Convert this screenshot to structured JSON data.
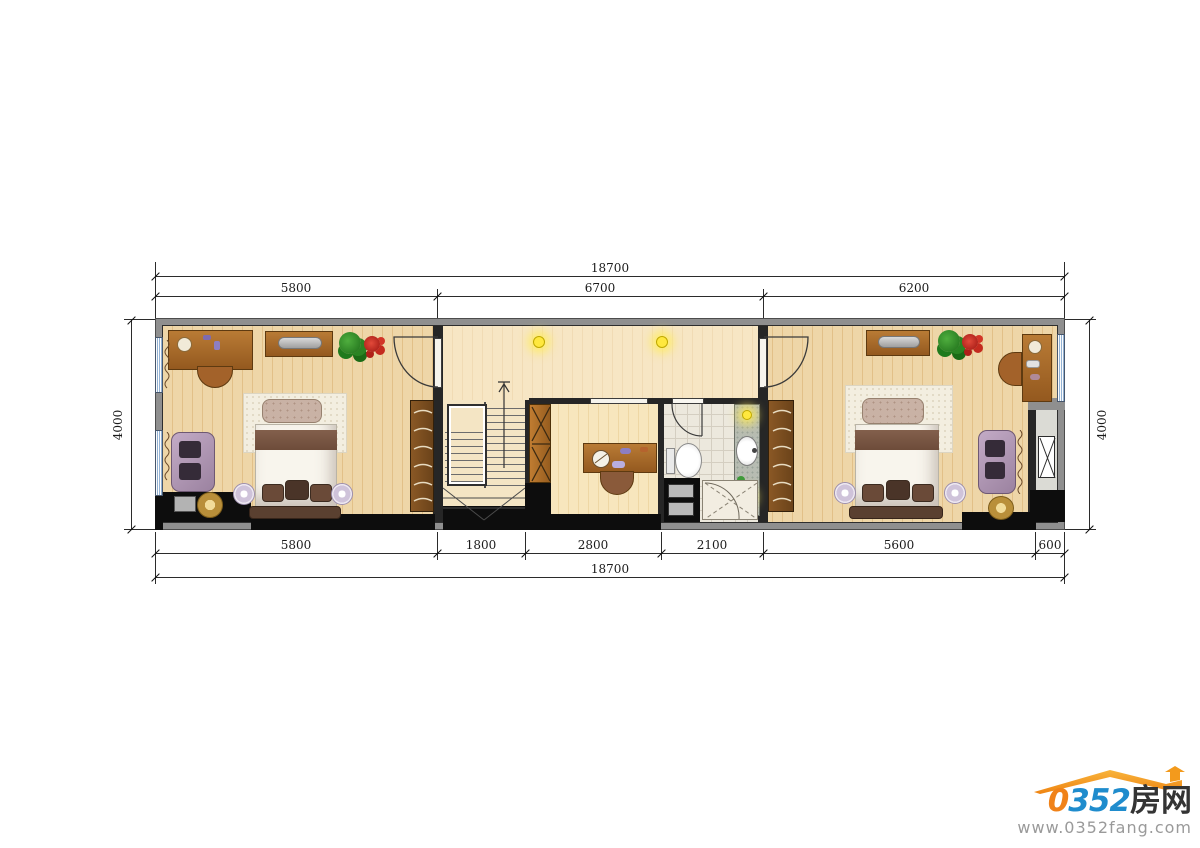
{
  "plan_dimensions": {
    "top_total": "18700",
    "top": [
      "5800",
      "6700",
      "6200"
    ],
    "bottom": [
      "5800",
      "1800",
      "2800",
      "2100",
      "5600",
      "600"
    ],
    "bottom_total": "18700",
    "left": "4000",
    "right": "4000"
  },
  "watermark": {
    "zero": "0",
    "num": "352",
    "cn": "房网",
    "url": "www.0352fang.com"
  },
  "colors": {
    "wall_gray": "#8f8f8f",
    "wall_black": "#0d0d0d",
    "floor_wood": "#ead0a0",
    "window_blue": "#93b2d4",
    "light_yellow": "#ffe83e",
    "logo_orange": "#f08219",
    "logo_blue": "#1f8ccd"
  },
  "icons": {
    "bed-icon": "rect+tufted headboard+pillows",
    "sofa-icon": "rounded rect with cushions",
    "wardrobe-icon": "brown rect with hanger strokes",
    "stairs-icon": "treads with up arrow",
    "toilet-icon": "oval bowl with tank",
    "sink-icon": "oval basin on counter",
    "shower-icon": "dashed diagonals with door arc",
    "ceiling-light-icon": "glowing yellow dot",
    "fan-icon": "gold circle",
    "plant-icon": "green/red clusters",
    "shaft-x-icon": "white box with X",
    "roof-icon": "orange roof with arrow"
  }
}
